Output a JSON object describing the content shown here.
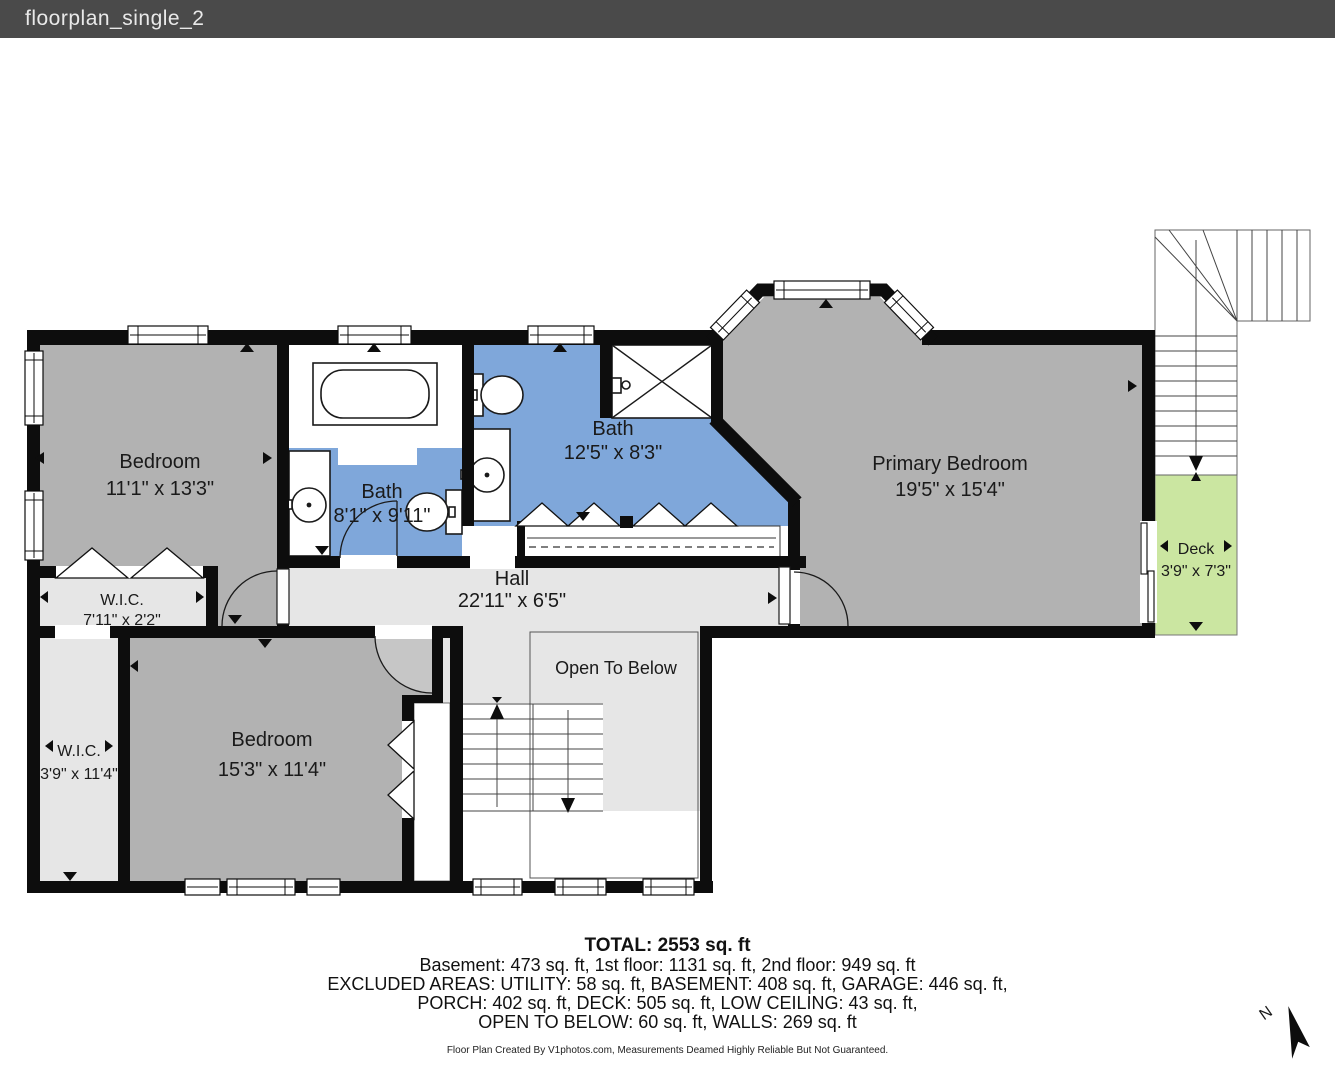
{
  "window": {
    "title": "floorplan_single_2"
  },
  "rooms": {
    "bedroom1": {
      "name": "Bedroom",
      "dims": "11'1\" x 13'3\""
    },
    "bath1": {
      "name": "Bath",
      "dims": "8'1\" x 9'11\""
    },
    "bath2": {
      "name": "Bath",
      "dims": "12'5\" x 8'3\""
    },
    "primary": {
      "name": "Primary Bedroom",
      "dims": "19'5\" x 15'4\""
    },
    "hall": {
      "name": "Hall",
      "dims": "22'11\" x 6'5\""
    },
    "wic1": {
      "name": "W.I.C.",
      "dims": "7'11\" x 2'2\""
    },
    "wic2": {
      "name": "W.I.C.",
      "dims": "3'9\" x 11'4\""
    },
    "bedroom2": {
      "name": "Bedroom",
      "dims": "15'3\" x 11'4\""
    },
    "open_to_below": {
      "name": "Open To Below"
    },
    "deck": {
      "name": "Deck",
      "dims": "3'9\" x 7'3\""
    }
  },
  "summary": {
    "total": "TOTAL: 2553 sq. ft",
    "line1": "Basement: 473 sq. ft, 1st floor: 1131 sq. ft, 2nd floor: 949 sq. ft",
    "line2": "EXCLUDED AREAS: UTILITY: 58 sq. ft, BASEMENT: 408 sq. ft, GARAGE: 446 sq. ft,",
    "line3": "PORCH: 402 sq. ft, DECK: 505 sq. ft, LOW CEILING: 43 sq. ft,",
    "line4": "OPEN TO BELOW: 60 sq. ft, WALLS: 269 sq. ft"
  },
  "footer": "Floor Plan Created By V1photos.com, Measurements Deamed Highly Reliable But Not Guaranteed.",
  "compass": {
    "label": "N"
  },
  "colors": {
    "titlebar": "#4a4a4a",
    "wall": "#0d0d0d",
    "room_gray": "#b2b2b2",
    "light_gray": "#e6e6e6",
    "swing_gray": "#c6c6c6",
    "bath_blue": "#7fa7da",
    "deck_green": "#cbe6a1"
  }
}
